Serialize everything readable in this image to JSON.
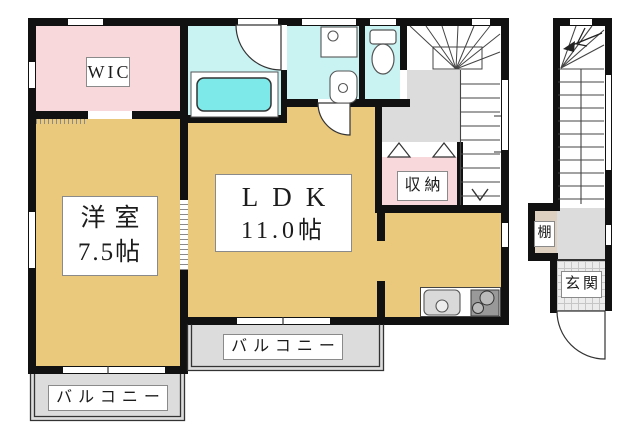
{
  "floorplan": {
    "rooms": {
      "wic": {
        "label": "WIC"
      },
      "western_room": {
        "label": "洋室",
        "size": "7.5帖"
      },
      "ldk": {
        "label": "LDK",
        "size": "11.0帖"
      },
      "storage": {
        "label": "収納"
      },
      "balcony_main": {
        "label": "バルコニー"
      },
      "balcony_west": {
        "label": "バルコニー"
      },
      "shelf": {
        "label": "棚"
      },
      "entrance": {
        "label": "玄関"
      }
    },
    "colors": {
      "wall": "#111111",
      "room-tan": "#eac87c",
      "room-pink": "#f8d8db",
      "room-cyan": "#c9f2f3",
      "tub-cyan": "#7de9e9",
      "floor-gray": "#dcdcdc",
      "tile-gray": "#ececec",
      "shelf-beige": "#ded1c2",
      "line": "#333333"
    }
  }
}
